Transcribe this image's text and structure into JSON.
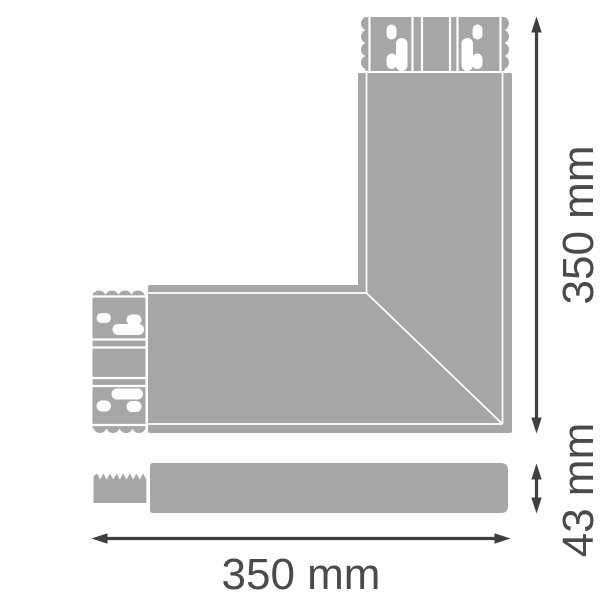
{
  "colors": {
    "background": "#ffffff",
    "part_fill": "#a6a6a6",
    "detail_white": "#ffffff",
    "dimension_lines": "#3f3f3f",
    "dimension_text": "#4a4a4a"
  },
  "dimensions": {
    "vertical": {
      "value": 350,
      "unit": "mm",
      "label": "350 mm"
    },
    "horizontal": {
      "value": 350,
      "unit": "mm",
      "label": "350 mm"
    },
    "thickness": {
      "value": 43,
      "unit": "mm",
      "label": "43 mm"
    }
  }
}
